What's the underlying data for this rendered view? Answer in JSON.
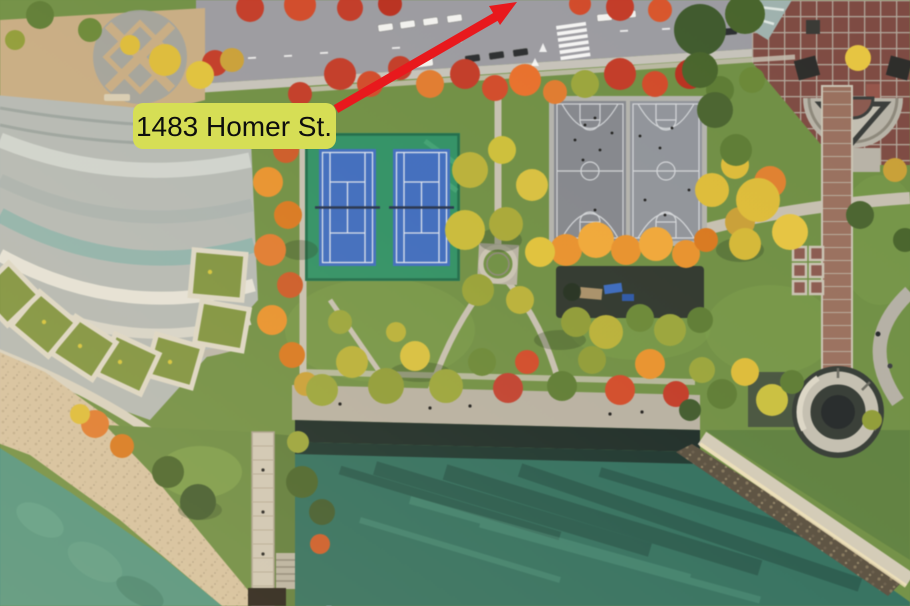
{
  "annotation": {
    "address_label": "1483 Homer St.",
    "label_bg_color": "#d6de55",
    "label_text_color": "#0e0e0e",
    "arrow_color": "#e8191d"
  },
  "palette": {
    "park_lawn": "#6f8f45",
    "street_asphalt": "#9b9ba1",
    "sidewalk": "#c6c3bb",
    "plaza_tan": "#c7ac84",
    "beach_sand": "#d5c2a2",
    "water_shallow": "#4f9380",
    "water_inlet": "#2e6e5f",
    "tennis_surround": "#2f9166",
    "tennis_court_blue": "#3e6cc0",
    "basketball_asphalt": "#84878e",
    "promenade_path": "#b7b1a4",
    "brick_plaza": "#7e4b43",
    "brick_path": "#99705f",
    "building_roof": "#b4b9b6",
    "terrace_garden": "#7e9340"
  }
}
